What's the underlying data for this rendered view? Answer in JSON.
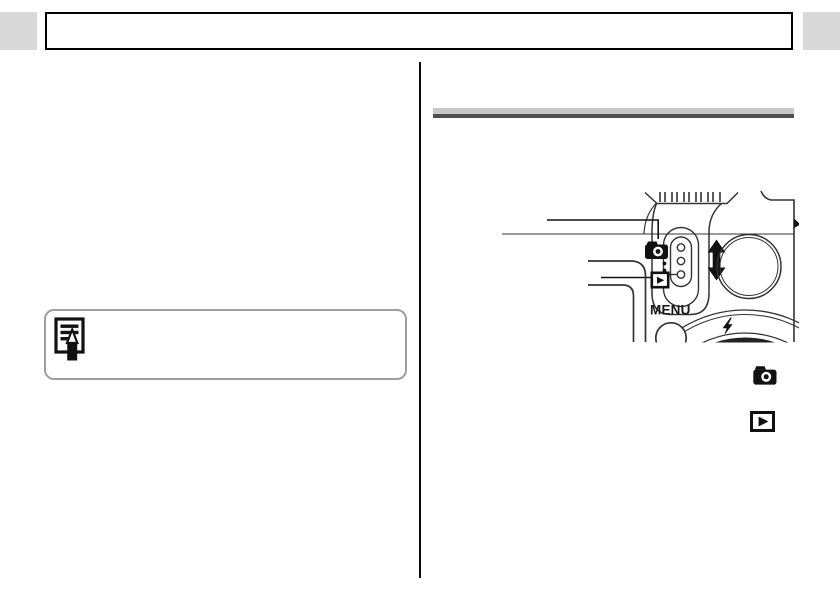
{
  "header": {
    "left_tab": "edge-tab",
    "right_tab": "edge-tab",
    "tab_color": "#d8d8d8",
    "title_box_border": "#000000"
  },
  "left_column": {
    "note_box": {
      "icon": "memo-pencil-icon",
      "border_color": "#9e9e9e"
    }
  },
  "right_column": {
    "section_rule": {
      "light_color": "#c9c9c9",
      "dark_color": "#4e4e4e"
    },
    "figure": {
      "menu_button_label": "MENU",
      "parts": [
        {
          "name": "grip-ridges"
        },
        {
          "name": "mode-switch-slider"
        },
        {
          "name": "shooting-mode-callout",
          "icon": "camera-icon"
        },
        {
          "name": "playback-mode-callout",
          "icon": "playback-icon"
        },
        {
          "name": "slide-direction",
          "icon": "up-down-arrow-icon"
        },
        {
          "name": "zoom-button-circle"
        },
        {
          "name": "menu-button"
        },
        {
          "name": "control-dial",
          "icon": "flash-bolt-icon"
        },
        {
          "name": "lcd-bezel-corner"
        }
      ]
    },
    "inline_icons": [
      {
        "name": "camera-icon"
      },
      {
        "name": "playback-icon"
      }
    ]
  },
  "ink": {
    "line_color": "#333333",
    "glyph_color": "#111111"
  }
}
